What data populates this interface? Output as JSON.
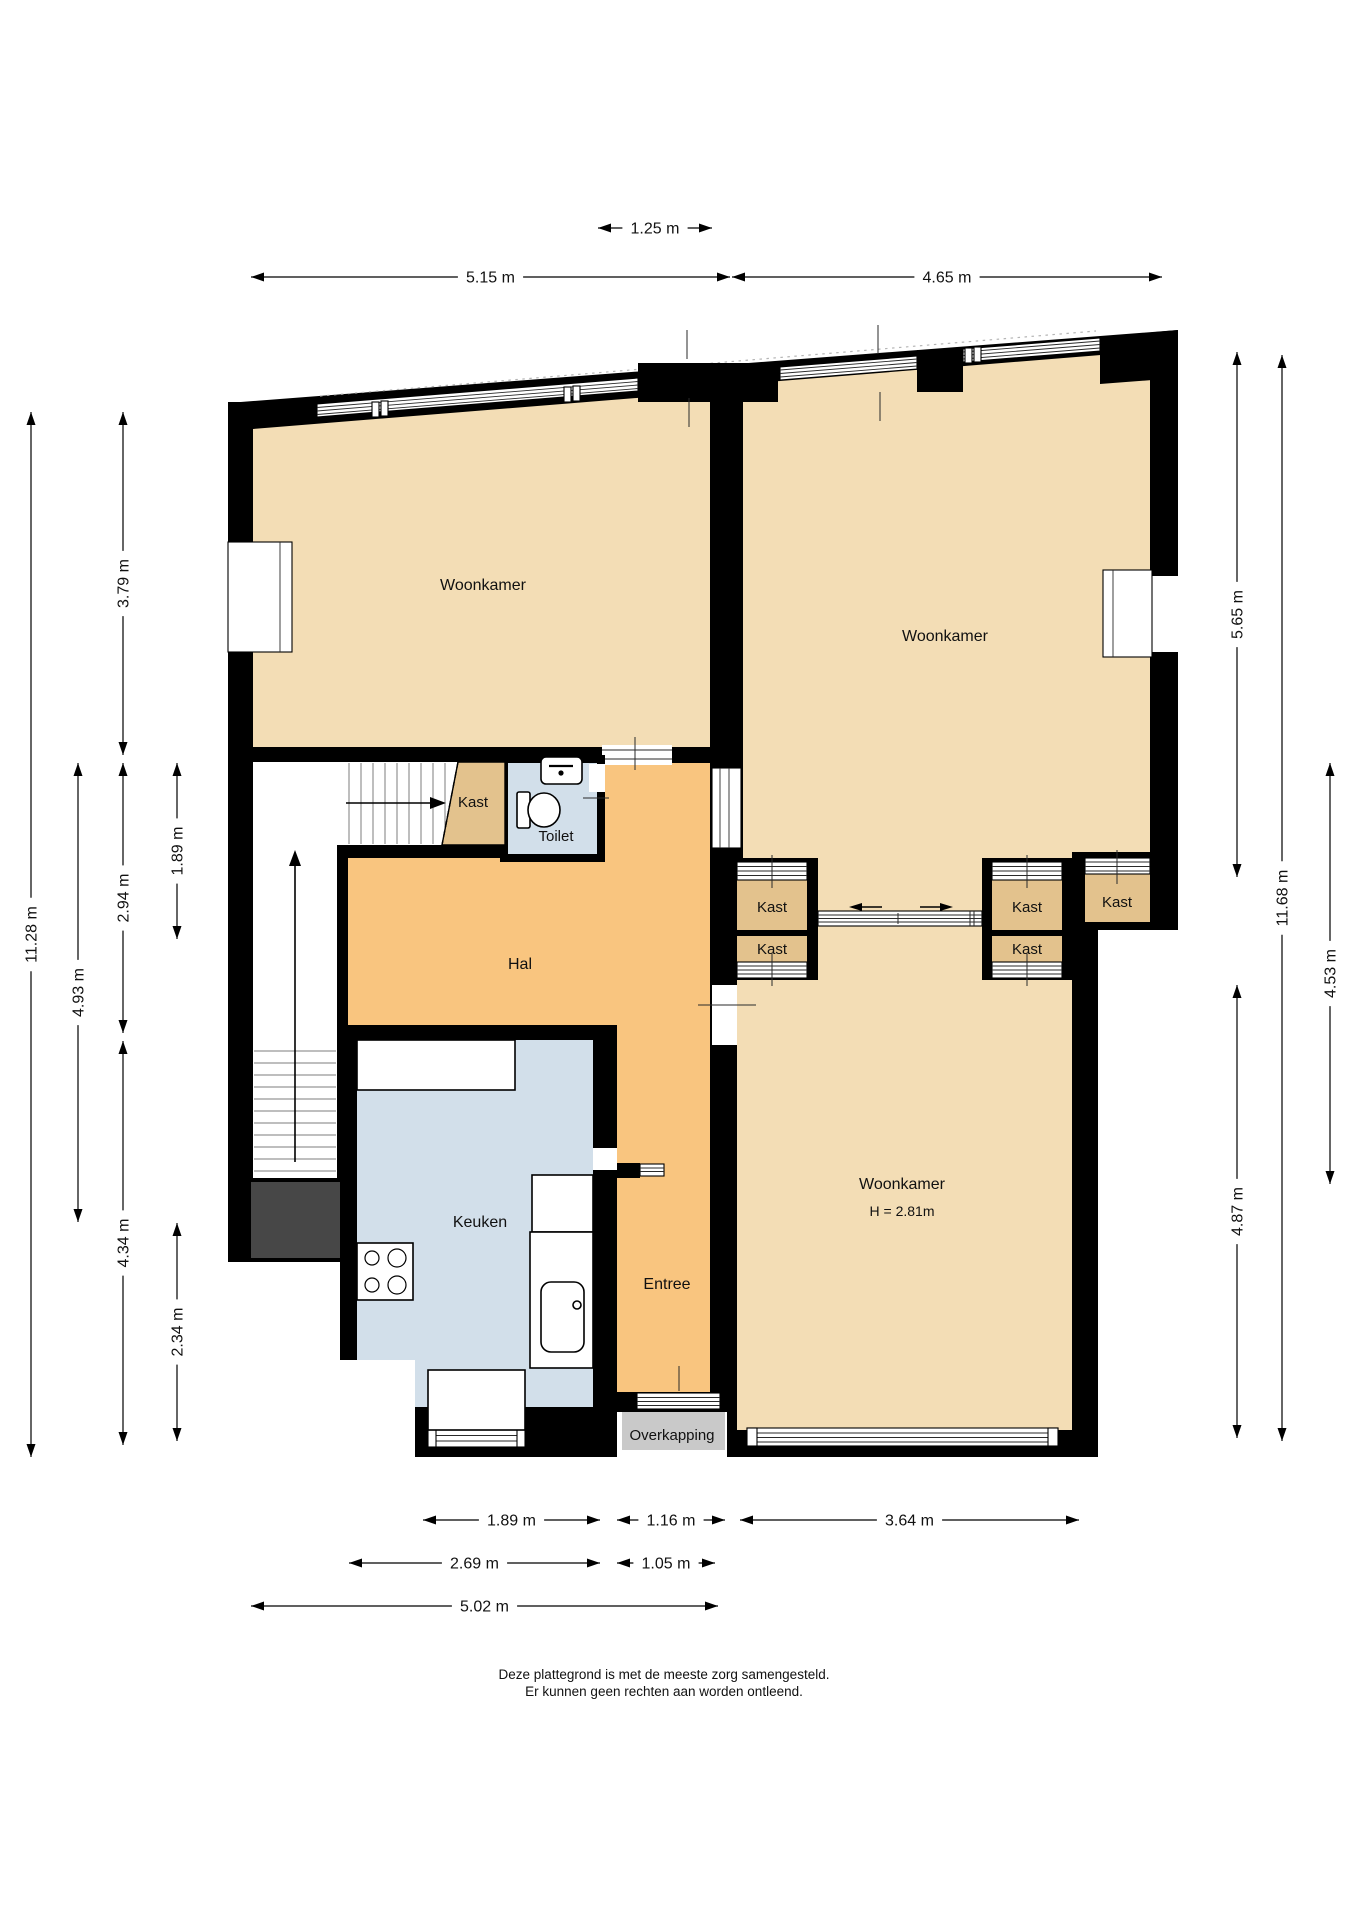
{
  "document_type": "floor-plan",
  "language": "nl",
  "colors": {
    "wall": "#000000",
    "living_room_floor": "#f3ddb5",
    "hall_floor": "#f9c57f",
    "kitchen_toilet_floor": "#d2dfea",
    "closet_fill": "#e3c28d",
    "canopy_fill": "#c9c9c9",
    "void_fill": "#474747",
    "background": "#ffffff"
  },
  "rooms": [
    {
      "id": "woonkamer-top-left",
      "label": "Woonkamer",
      "x": 483,
      "y": 590,
      "fs": 16
    },
    {
      "id": "woonkamer-top-right",
      "label": "Woonkamer",
      "x": 945,
      "y": 641,
      "fs": 16
    },
    {
      "id": "woonkamer-bottom-right",
      "label": "Woonkamer",
      "x": 902,
      "y": 1189,
      "fs": 16,
      "sublabel": "H = 2.81m",
      "sub_y": 1216,
      "sub_fs": 14
    },
    {
      "id": "hal",
      "label": "Hal",
      "x": 520,
      "y": 969,
      "fs": 16
    },
    {
      "id": "keuken",
      "label": "Keuken",
      "x": 480,
      "y": 1227,
      "fs": 16
    },
    {
      "id": "entree",
      "label": "Entree",
      "x": 667,
      "y": 1289,
      "fs": 16
    },
    {
      "id": "toilet",
      "label": "Toilet",
      "x": 556,
      "y": 841,
      "fs": 15
    },
    {
      "id": "overkapping",
      "label": "Overkapping",
      "x": 672,
      "y": 1440,
      "fs": 15
    },
    {
      "id": "kast-under-stairs",
      "label": "Kast",
      "x": 473,
      "y": 807,
      "fs": 15
    },
    {
      "id": "kast-ensuite-left-top",
      "label": "Kast",
      "x": 772,
      "y": 912,
      "fs": 15
    },
    {
      "id": "kast-ensuite-left-bottom",
      "label": "Kast",
      "x": 772,
      "y": 954,
      "fs": 15
    },
    {
      "id": "kast-ensuite-right-top",
      "label": "Kast",
      "x": 1027,
      "y": 912,
      "fs": 15
    },
    {
      "id": "kast-ensuite-right-bottom",
      "label": "Kast",
      "x": 1027,
      "y": 954,
      "fs": 15
    },
    {
      "id": "kast-corner",
      "label": "Kast",
      "x": 1117,
      "y": 907,
      "fs": 15
    }
  ],
  "dimensions": {
    "horizontal": [
      {
        "label": "1.25 m",
        "x1": 598,
        "x2": 712,
        "y": 228
      },
      {
        "label": "5.15 m",
        "x1": 251,
        "x2": 730,
        "y": 277
      },
      {
        "label": "4.65 m",
        "x1": 732,
        "x2": 1162,
        "y": 277
      },
      {
        "label": "1.89 m",
        "x1": 423,
        "x2": 600,
        "y": 1520
      },
      {
        "label": "1.16 m",
        "x1": 617,
        "x2": 725,
        "y": 1520
      },
      {
        "label": "3.64 m",
        "x1": 740,
        "x2": 1079,
        "y": 1520
      },
      {
        "label": "2.69 m",
        "x1": 349,
        "x2": 600,
        "y": 1563
      },
      {
        "label": "1.05 m",
        "x1": 617,
        "x2": 715,
        "y": 1563
      },
      {
        "label": "5.02 m",
        "x1": 251,
        "x2": 718,
        "y": 1606
      }
    ],
    "vertical": [
      {
        "label": "11.28 m",
        "x": 31,
        "y1": 412,
        "y2": 1457
      },
      {
        "label": "3.79 m",
        "x": 123,
        "y1": 412,
        "y2": 755
      },
      {
        "label": "2.94 m",
        "x": 123,
        "y1": 763,
        "y2": 1033
      },
      {
        "label": "4.34 m",
        "x": 123,
        "y1": 1041,
        "y2": 1445
      },
      {
        "label": "1.89 m",
        "x": 177,
        "y1": 763,
        "y2": 939
      },
      {
        "label": "2.34 m",
        "x": 177,
        "y1": 1223,
        "y2": 1441
      },
      {
        "label": "4.93 m",
        "x": 78,
        "y1": 763,
        "y2": 1222
      },
      {
        "label": "5.65 m",
        "x": 1237,
        "y1": 352,
        "y2": 877
      },
      {
        "label": "11.68 m",
        "x": 1282,
        "y1": 355,
        "y2": 1441
      },
      {
        "label": "4.53 m",
        "x": 1330,
        "y1": 763,
        "y2": 1184
      },
      {
        "label": "4.87 m",
        "x": 1237,
        "y1": 985,
        "y2": 1438
      }
    ]
  },
  "footer": {
    "line1": "Deze plattegrond is met de meeste zorg samengesteld.",
    "line2": "Er kunnen geen rechten aan worden ontleend."
  }
}
